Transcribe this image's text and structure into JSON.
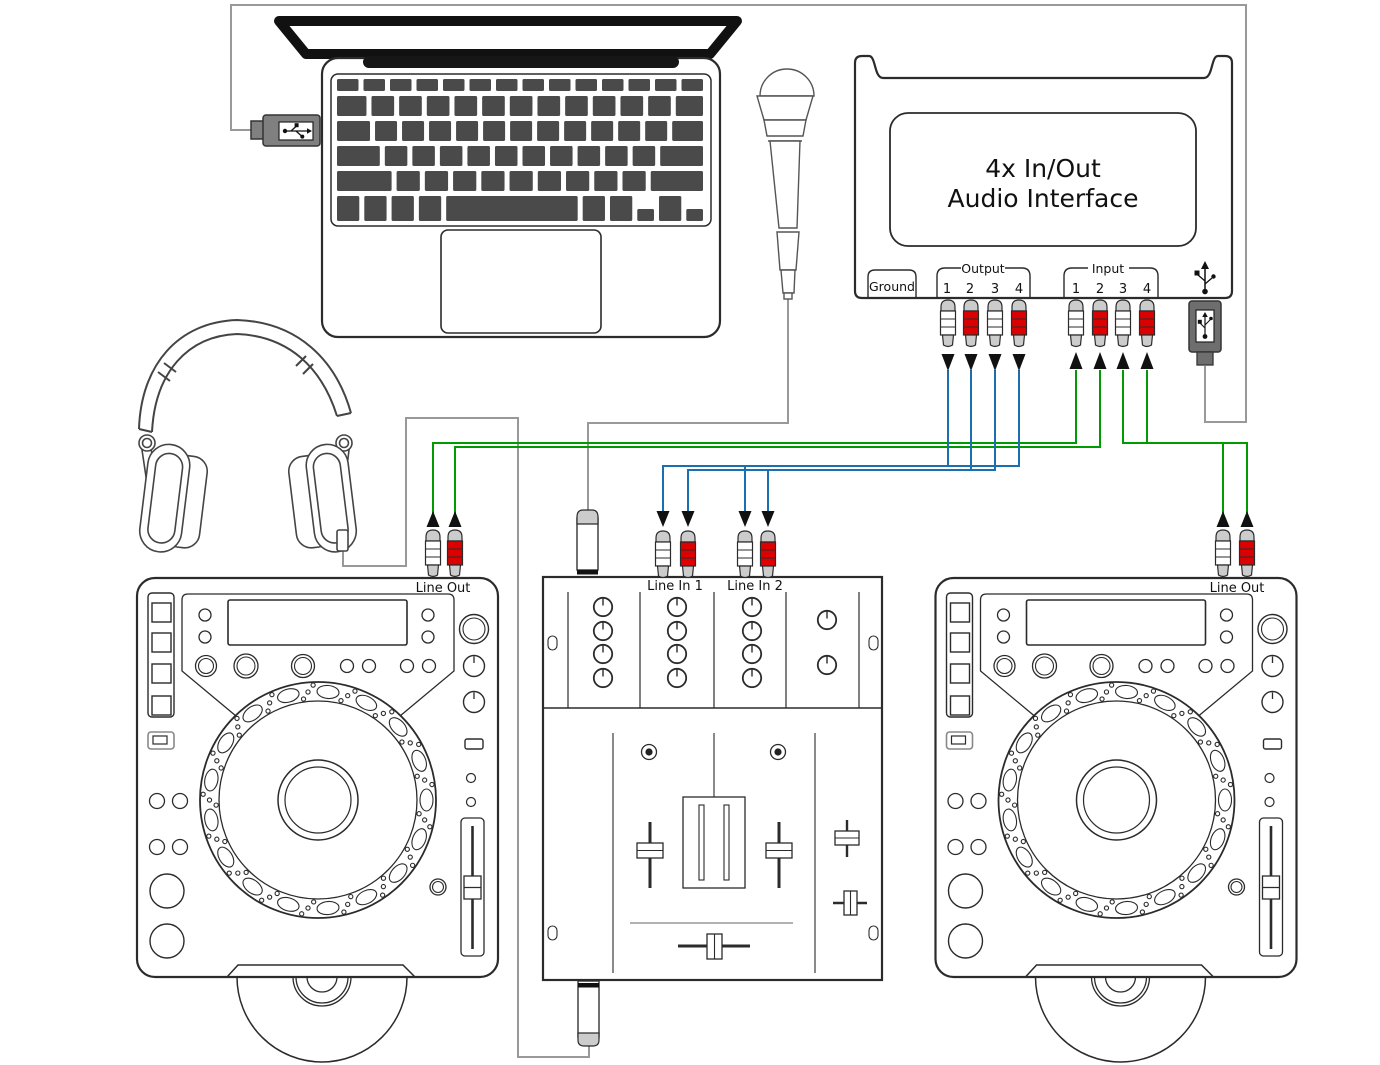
{
  "diagram": {
    "devices": {
      "laptop": {
        "name": "laptop"
      },
      "microphone": {
        "name": "microphone"
      },
      "headphones": {
        "name": "headphones"
      },
      "audio_interface": {
        "title_line1": "4x In/Out",
        "title_line2": "Audio Interface",
        "ground_label": "Ground",
        "output_group_label": "Output",
        "input_group_label": "Input",
        "output_ports": [
          "1",
          "2",
          "3",
          "4"
        ],
        "input_ports": [
          "1",
          "2",
          "3",
          "4"
        ],
        "usb_icon": "usb-icon"
      },
      "left_deck": {
        "line_out_label": "Line Out"
      },
      "right_deck": {
        "line_out_label": "Line Out"
      },
      "mixer": {
        "line_in_labels": [
          "Line In 1",
          "Line In 2"
        ]
      }
    },
    "connections": [
      {
        "from": "laptop-usb",
        "to": "audio-interface-usb",
        "type": "usb-cable",
        "color": "gray"
      },
      {
        "from": "left-deck-line-out",
        "to": "interface-inputs-1-2",
        "type": "rca",
        "color": "green"
      },
      {
        "from": "right-deck-line-out",
        "to": "interface-inputs-3-4",
        "type": "rca",
        "color": "green"
      },
      {
        "from": "interface-outputs-1-2",
        "to": "mixer-line-in-1",
        "type": "rca",
        "color": "blue"
      },
      {
        "from": "interface-outputs-3-4",
        "to": "mixer-line-in-2",
        "type": "rca",
        "color": "blue"
      },
      {
        "from": "headphones",
        "to": "mixer-phones-jack",
        "type": "quarter-inch-jack",
        "color": "gray"
      },
      {
        "from": "microphone",
        "to": "mixer-mic-jack",
        "type": "quarter-inch-jack",
        "color": "gray"
      }
    ],
    "colors": {
      "cable_green": "#009b00",
      "cable_blue": "#1a6fb0",
      "cable_gray": "#999999",
      "rca_red": "#dd0000",
      "connector_cap_gray": "#cccccc",
      "device_outline": "#2b2b2b",
      "key_gray": "#4a4a4a",
      "usb_plug_gray": "#808080"
    }
  }
}
